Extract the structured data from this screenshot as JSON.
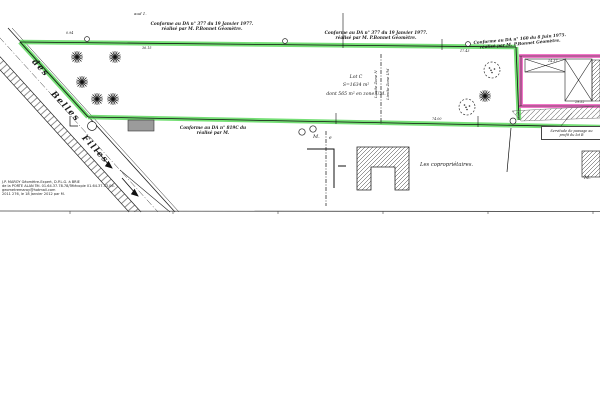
{
  "plan": {
    "notes": {
      "top_note": "aud 1."
    },
    "conformity": {
      "a": {
        "line1": "Conforme au DA n° 377 du 19 Janvier 1977.",
        "line2": "réalisé par M. P.Bonnet Géomètre."
      },
      "b": {
        "line1": "Conforme au DA n° 377 du 19 Janvier 1977.",
        "line2": "réalisé par M. P.Bonnet Géomètre."
      },
      "c": {
        "line1": "Conforme au DA n° 160 du 8 Juin 1975.",
        "line2": "réalisé par M. P.Bonnet Géomètre."
      },
      "d": {
        "line1": "Conforme au DA n° 819C du",
        "line2": "réalisé par M."
      }
    },
    "lot": {
      "name": "Lot C",
      "area": "S=1634 m²",
      "zone_detail": "dont 565 m² en zone UM."
    },
    "zone_limits": {
      "n": "Limite Zone N",
      "um": "Limite Zone UM"
    },
    "servitude": {
      "line1": "Servitude de passage au",
      "line2": "profit du lot B"
    },
    "labels": {
      "coproprietaires": "Les copropriétaires.",
      "owner_m": "M.",
      "owner_e": "e",
      "owner_m_right": "M."
    },
    "street": {
      "word1": "des",
      "word2": "Belles",
      "word3": "Filles"
    },
    "dimensions": {
      "d_094": "0.94",
      "d_3615": "36.15",
      "d_1743": "17.43",
      "d_7400": "74.00",
      "d_1437": "14.37",
      "d_2952": "29.52"
    },
    "surveyor": {
      "line1": "J.P. MAROY Géomètre-Expert, D.P.L.G. à BRIE",
      "line2": "de la PORTE ALAN   Tél. 01.64.37.78.78/Télécopie 01.64.37.53.06.",
      "line3": "geometremaroy@hotmail.com",
      "line4": "2011 276,  le 18 Janvier 2012 par M."
    },
    "colors": {
      "boundary_green": "#55d855",
      "boundary_pink": "#f05fc0",
      "ink": "#1c1c1c"
    }
  }
}
